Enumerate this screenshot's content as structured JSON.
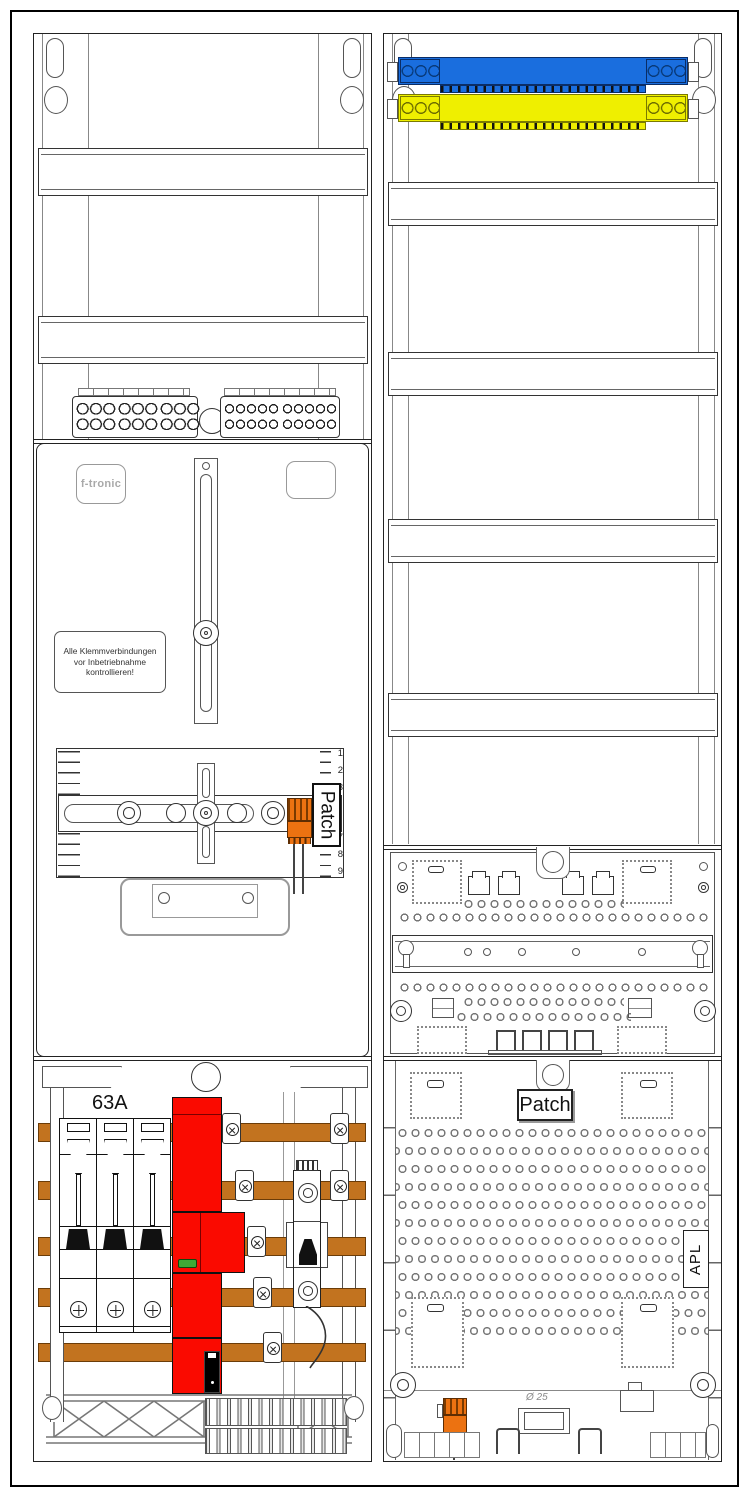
{
  "left_column": {
    "brand_badge_label": "f-tronic",
    "warning_label_lines": [
      "Alle Klemmverbindungen",
      "vor Inbetriebnahme",
      "kontrollieren!"
    ],
    "meter_mount": {
      "patch_label": "Patch",
      "ruler_numbers_top": [
        "1",
        "2",
        "3"
      ],
      "ruler_numbers_bottom": [
        "7",
        "8",
        "9"
      ]
    },
    "fuse_rating_label": "63A"
  },
  "right_column": {
    "patch_panel_label": "Patch",
    "apl_label": "APL",
    "cable_diameter_label": "Ø 25"
  },
  "colors": {
    "neutral_busbar_blue": "#1a6ede",
    "pe_busbar_yellow": "#efef00",
    "main_breaker_red": "#fa0a00",
    "indicator_green": "#3faa36",
    "copper_busbar": "#c2731f",
    "connector_orange": "#ec7211"
  }
}
